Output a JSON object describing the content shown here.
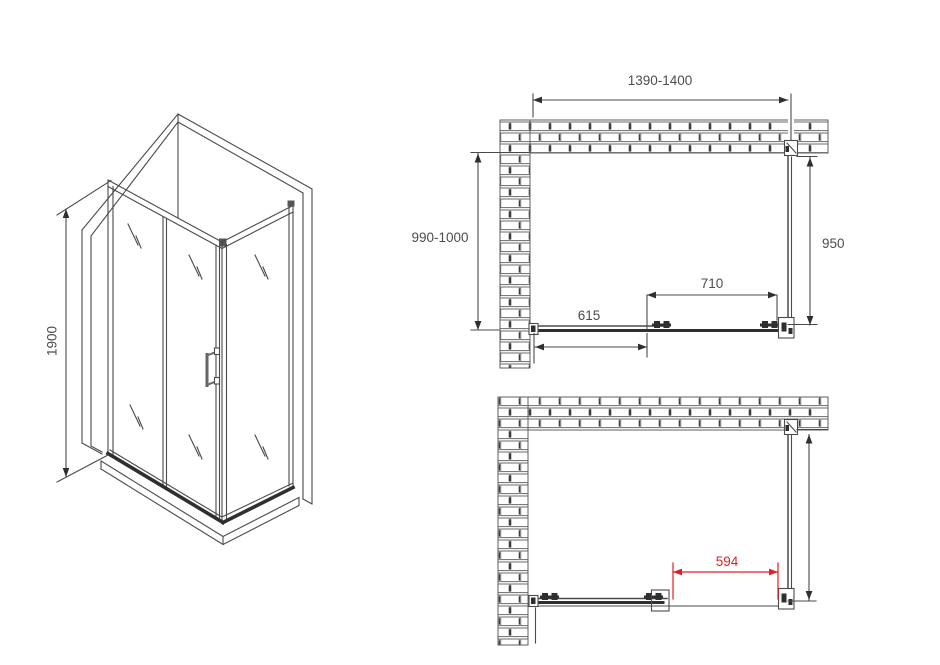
{
  "colors": {
    "line": "#4a4a4a",
    "line_dark": "#2f2f2f",
    "accent_red": "#e31e24",
    "wall_outline": "#5f5f5f",
    "background": "#ffffff"
  },
  "iso_view": {
    "height_label": "1900"
  },
  "plan_top": {
    "width_label": "1390-1400",
    "depth_label": "990-1000",
    "side_panel_label": "950",
    "door_label": "710",
    "fixed_panel_label": "615"
  },
  "plan_bottom": {
    "opening_label": "594"
  }
}
